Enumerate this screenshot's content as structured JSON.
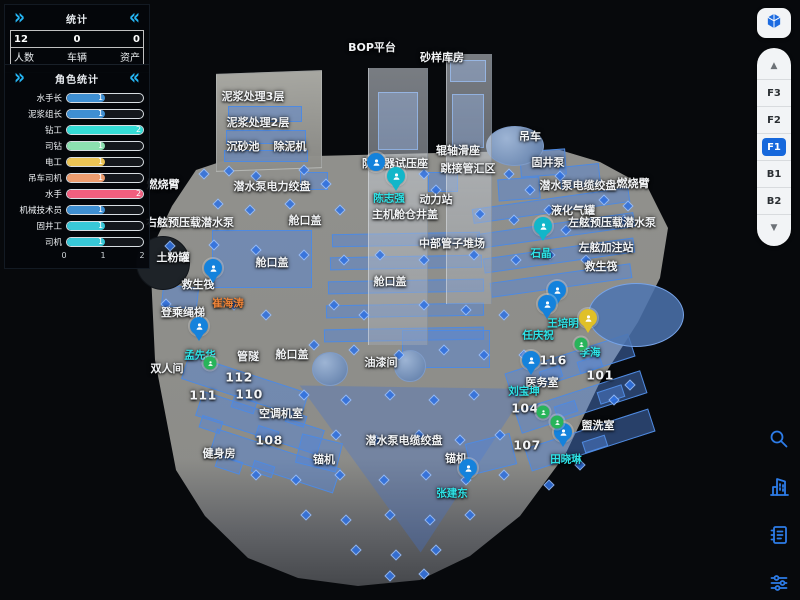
{
  "stats_panel": {
    "title": "统计",
    "chevron_left": "»",
    "chevron_right": "«",
    "items": [
      {
        "value": "12",
        "label": "人数"
      },
      {
        "value": "0",
        "label": "车辆"
      },
      {
        "value": "0",
        "label": "资产"
      }
    ]
  },
  "role_panel": {
    "title": "角色统计",
    "chevron_left": "»",
    "chevron_right": "«",
    "max": 2,
    "axis": [
      "0",
      "1",
      "2"
    ],
    "bars": [
      {
        "label": "水手长",
        "value": 1,
        "color": "#3f8fd2"
      },
      {
        "label": "泥浆组长",
        "value": 1,
        "color": "#3f8fd2"
      },
      {
        "label": "钻工",
        "value": 2,
        "color": "#35dcd6"
      },
      {
        "label": "司钻",
        "value": 1,
        "color": "#8ce0b0"
      },
      {
        "label": "电工",
        "value": 1,
        "color": "#ecc455"
      },
      {
        "label": "吊车司机",
        "value": 1,
        "color": "#ee9d6f"
      },
      {
        "label": "水手",
        "value": 2,
        "color": "#f25f7f"
      },
      {
        "label": "机械技术员",
        "value": 1,
        "color": "#3f8fd2"
      },
      {
        "label": "固井工",
        "value": 1,
        "color": "#38c8d8"
      },
      {
        "label": "司机",
        "value": 1,
        "color": "#38c8d8"
      }
    ]
  },
  "floor_panel": {
    "cube_icon": "cube-3d-icon",
    "up_arrow": "▲",
    "down_arrow": "▼",
    "floors": [
      "F3",
      "F2",
      "F1",
      "B1",
      "B2"
    ],
    "active": "F1",
    "active_color": "#1668dc"
  },
  "toolbar": {
    "icon_color": "#2d7ce8",
    "icons": [
      "search-icon",
      "building-icon",
      "list-icon",
      "filter-sliders-icon"
    ]
  },
  "map": {
    "person_cyan_color": "#2ee4e8",
    "person_orange_color": "#ef8438",
    "rooms": [
      {
        "t": "BOP平台",
        "x": 372,
        "y": 47
      },
      {
        "t": "砂样库房",
        "x": 442,
        "y": 57
      },
      {
        "t": "泥浆处理3层",
        "x": 253,
        "y": 96
      },
      {
        "t": "泥浆处理2层",
        "x": 258,
        "y": 122
      },
      {
        "t": "沉砂池",
        "x": 243,
        "y": 146
      },
      {
        "t": "除泥机",
        "x": 290,
        "y": 146
      },
      {
        "t": "吊车",
        "x": 530,
        "y": 136
      },
      {
        "t": "固井泵",
        "x": 548,
        "y": 162
      },
      {
        "t": "辊轴滑座",
        "x": 458,
        "y": 150
      },
      {
        "t": "跳接管汇区",
        "x": 468,
        "y": 168
      },
      {
        "t": "潜水泵电缆绞盘",
        "x": 578,
        "y": 185
      },
      {
        "t": "燃烧臂",
        "x": 633,
        "y": 183
      },
      {
        "t": "液化气罐",
        "x": 573,
        "y": 210
      },
      {
        "t": "左舷预压载潜水泵",
        "x": 612,
        "y": 222
      },
      {
        "t": "左舷加注站",
        "x": 606,
        "y": 247
      },
      {
        "t": "救生筏",
        "x": 601,
        "y": 266
      },
      {
        "t": "燃烧臂",
        "x": 163,
        "y": 184
      },
      {
        "t": "潜水泵电力绞盘",
        "x": 272,
        "y": 186
      },
      {
        "t": "右舷预压载潜水泵",
        "x": 190,
        "y": 222
      },
      {
        "t": "土粉罐",
        "x": 173,
        "y": 257
      },
      {
        "t": "舱口盖",
        "x": 272,
        "y": 262
      },
      {
        "t": "舱口盖",
        "x": 305,
        "y": 220
      },
      {
        "t": "主机舱仓井盖",
        "x": 405,
        "y": 214
      },
      {
        "t": "中部管子堆场",
        "x": 452,
        "y": 243
      },
      {
        "t": "防喷器试压座",
        "x": 395,
        "y": 163
      },
      {
        "t": "动力站",
        "x": 436,
        "y": 199
      },
      {
        "t": "舱口盖",
        "x": 390,
        "y": 281
      },
      {
        "t": "油漆间",
        "x": 381,
        "y": 362
      },
      {
        "t": "潜水泵电缆绞盘",
        "x": 404,
        "y": 440
      },
      {
        "t": "锚机",
        "x": 324,
        "y": 459
      },
      {
        "t": "锚机",
        "x": 456,
        "y": 458
      },
      {
        "t": "救生筏",
        "x": 198,
        "y": 284
      },
      {
        "t": "登乘绳梯",
        "x": 183,
        "y": 312
      },
      {
        "t": "双人间",
        "x": 167,
        "y": 368
      },
      {
        "t": "管隧",
        "x": 248,
        "y": 356
      },
      {
        "t": "舱口盖",
        "x": 292,
        "y": 354
      },
      {
        "t": "空调机室",
        "x": 281,
        "y": 413
      },
      {
        "t": "健身房",
        "x": 219,
        "y": 453
      },
      {
        "t": "医务室",
        "x": 542,
        "y": 382
      },
      {
        "t": "盥洗室",
        "x": 598,
        "y": 425
      }
    ],
    "room_numbers": [
      {
        "t": "112",
        "x": 239,
        "y": 377
      },
      {
        "t": "110",
        "x": 249,
        "y": 394
      },
      {
        "t": "111",
        "x": 203,
        "y": 395
      },
      {
        "t": "108",
        "x": 269,
        "y": 440
      },
      {
        "t": "116",
        "x": 553,
        "y": 360
      },
      {
        "t": "101",
        "x": 600,
        "y": 375
      },
      {
        "t": "104",
        "x": 525,
        "y": 408
      },
      {
        "t": "107",
        "x": 527,
        "y": 445
      }
    ],
    "persons": [
      {
        "t": "石晶",
        "x": 541,
        "y": 253,
        "c": "cyan"
      },
      {
        "t": "王培明",
        "x": 563,
        "y": 323,
        "c": "cyan"
      },
      {
        "t": "任庆祝",
        "x": 538,
        "y": 335,
        "c": "cyan"
      },
      {
        "t": "李海",
        "x": 590,
        "y": 352,
        "c": "cyan"
      },
      {
        "t": "刘宝坤",
        "x": 524,
        "y": 391,
        "c": "cyan"
      },
      {
        "t": "田晓琳",
        "x": 566,
        "y": 459,
        "c": "cyan"
      },
      {
        "t": "张建东",
        "x": 452,
        "y": 493,
        "c": "cyan"
      },
      {
        "t": "孟先华",
        "x": 200,
        "y": 355,
        "c": "cyan"
      },
      {
        "t": "陈志强",
        "x": 389,
        "y": 198,
        "c": "cyan"
      },
      {
        "t": "崔海涛",
        "x": 228,
        "y": 303,
        "c": "orange"
      }
    ],
    "pins": [
      {
        "type": "blue",
        "x": 213,
        "y": 268
      },
      {
        "type": "blue",
        "x": 199,
        "y": 326
      },
      {
        "type": "teal",
        "x": 396,
        "y": 176
      },
      {
        "type": "badge",
        "x": 376,
        "y": 162
      },
      {
        "type": "teal",
        "x": 543,
        "y": 226
      },
      {
        "type": "blue",
        "x": 557,
        "y": 290
      },
      {
        "type": "blue",
        "x": 547,
        "y": 304
      },
      {
        "type": "yellow",
        "x": 588,
        "y": 318
      },
      {
        "type": "blue",
        "x": 531,
        "y": 360
      },
      {
        "type": "blue",
        "x": 563,
        "y": 432
      },
      {
        "type": "blue",
        "x": 468,
        "y": 468
      },
      {
        "type": "green",
        "x": 210,
        "y": 363
      },
      {
        "type": "green",
        "x": 581,
        "y": 344
      },
      {
        "type": "green",
        "x": 543,
        "y": 412
      },
      {
        "type": "green",
        "x": 557,
        "y": 422
      }
    ]
  }
}
